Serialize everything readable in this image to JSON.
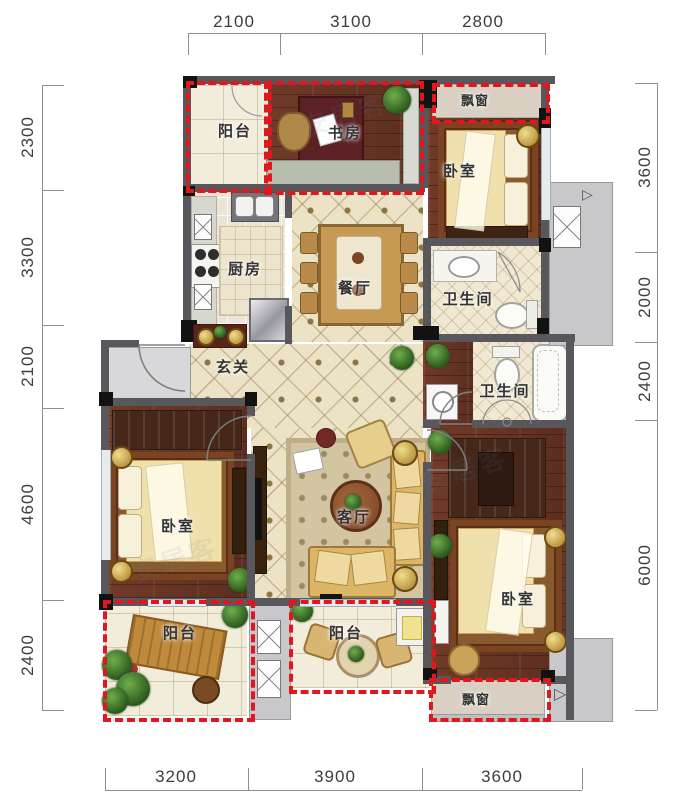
{
  "rooms": {
    "balcony_tl": "阳台",
    "study": "书房",
    "bay_top": "飘窗",
    "bedroom_tr": "卧室",
    "kitchen": "厨房",
    "dining": "餐厅",
    "bath_upper": "卫生间",
    "entry": "玄关",
    "bath_lower": "卫生间",
    "bedroom_left": "卧室",
    "living": "客厅",
    "bedroom_br": "卧室",
    "balcony_bl": "阳台",
    "balcony_bm": "阳台",
    "bay_bottom": "飘窗"
  },
  "dimensions": {
    "top": [
      "2100",
      "3100",
      "2800"
    ],
    "left": [
      "2300",
      "3300",
      "2100",
      "4600",
      "2400"
    ],
    "right": [
      "3600",
      "2000",
      "2400",
      "6000"
    ],
    "bottom": [
      "3200",
      "3900",
      "3600"
    ]
  },
  "watermark": "安居客",
  "colors": {
    "dash_red": "#e1161e",
    "wall_gray": "#57575c",
    "wood_floor": "#6d3728",
    "tile_floor": "#ece3c6",
    "common_gray": "#c8c8ca"
  }
}
